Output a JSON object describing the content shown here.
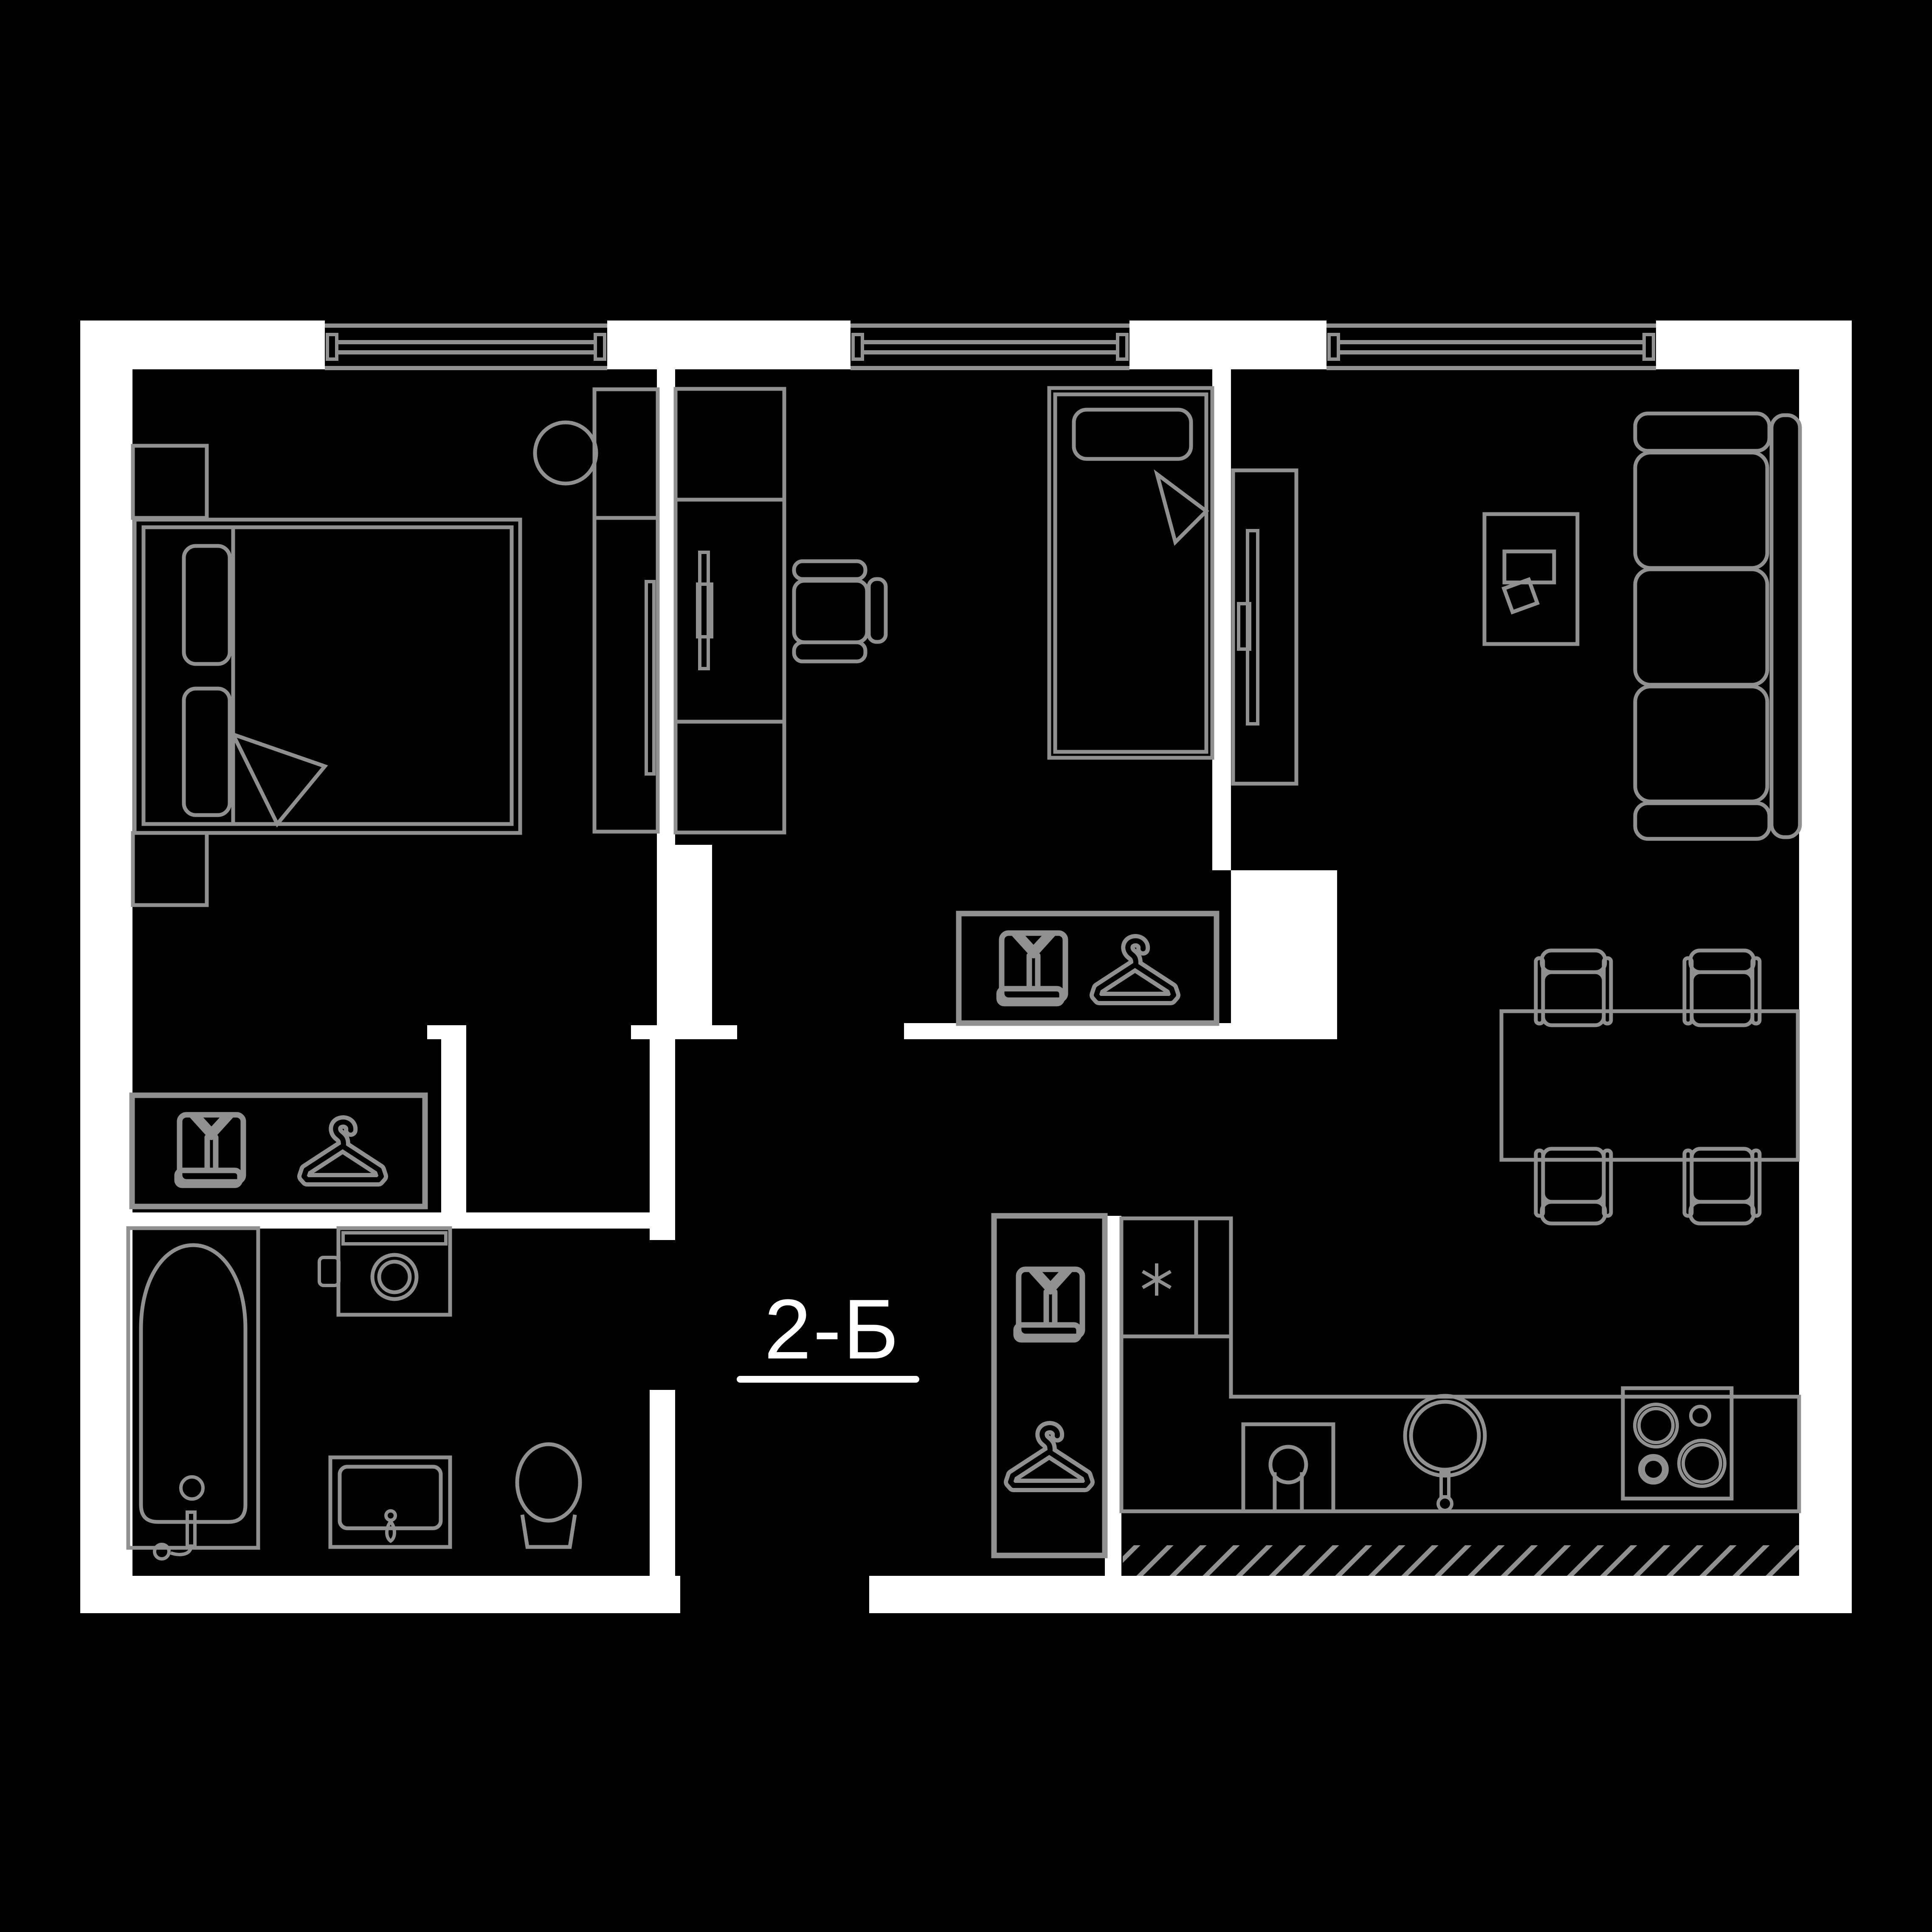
{
  "plan": {
    "label": "2-Б",
    "colors": {
      "background": "#000000",
      "walls": "#ffffff",
      "furniture_lines": "#909090",
      "label_text": "#ffffff"
    },
    "icons": [
      "shirt-icon",
      "hanger-icon",
      "snowflake-icon"
    ],
    "furniture": [
      "double-bed",
      "nightstand",
      "wardrobe",
      "desk-unit",
      "desk-chair",
      "single-bed",
      "tv-stand",
      "sofa",
      "coffee-table",
      "dining-table",
      "dining-chair",
      "fridge",
      "kitchen-counter",
      "kitchen-sink",
      "stove",
      "bathtub",
      "washing-machine",
      "bathroom-sink",
      "toilet"
    ]
  }
}
